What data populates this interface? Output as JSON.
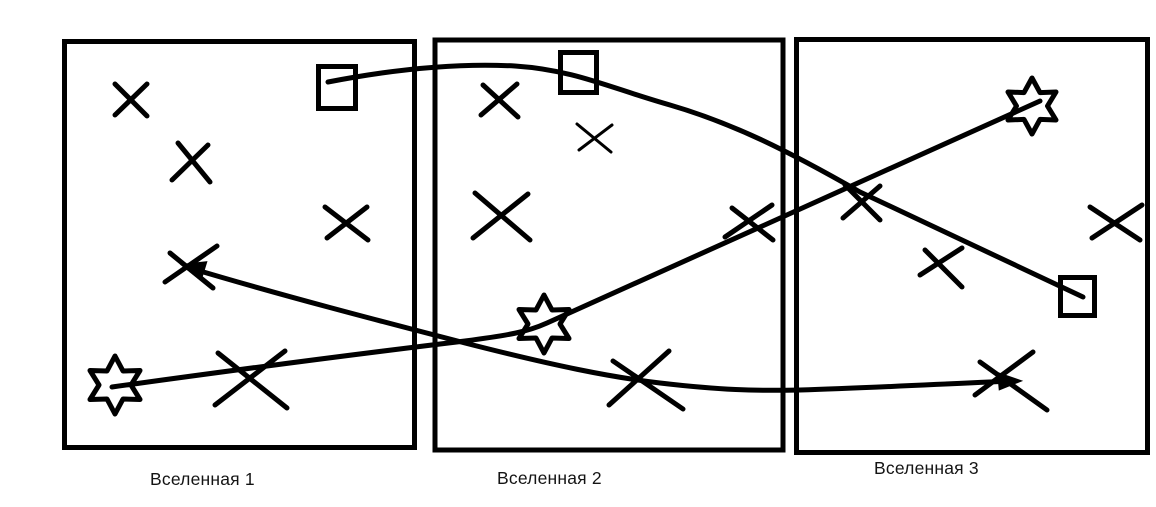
{
  "canvas": {
    "background": "#ffffff",
    "ink": "#000000"
  },
  "universes": [
    {
      "label": "Вселенная 1",
      "objects": {
        "crosses": 5,
        "squares": 1,
        "stars": 1
      }
    },
    {
      "label": "Вселенная 2",
      "objects": {
        "crosses": 5,
        "squares": 1,
        "stars": 1
      }
    },
    {
      "label": "Вселенная 3",
      "objects": {
        "crosses": 4,
        "squares": 1,
        "stars": 1
      }
    }
  ],
  "connections": [
    {
      "id": "squares-link",
      "connects": [
        "universe-1-square",
        "universe-2-square",
        "universe-3-square"
      ],
      "style": "arched curve, no arrowheads"
    },
    {
      "id": "stars-link",
      "connects": [
        "universe-1-star",
        "universe-2-star",
        "universe-3-star"
      ],
      "style": "line bending upward at universe-2 star, no arrowheads"
    },
    {
      "id": "crosses-link",
      "connects": [
        "universe-1-cross",
        "universe-2-cross",
        "universe-3-cross"
      ],
      "style": "shallow curve with arrowheads at universe-1 and universe-3 cross ends"
    }
  ]
}
